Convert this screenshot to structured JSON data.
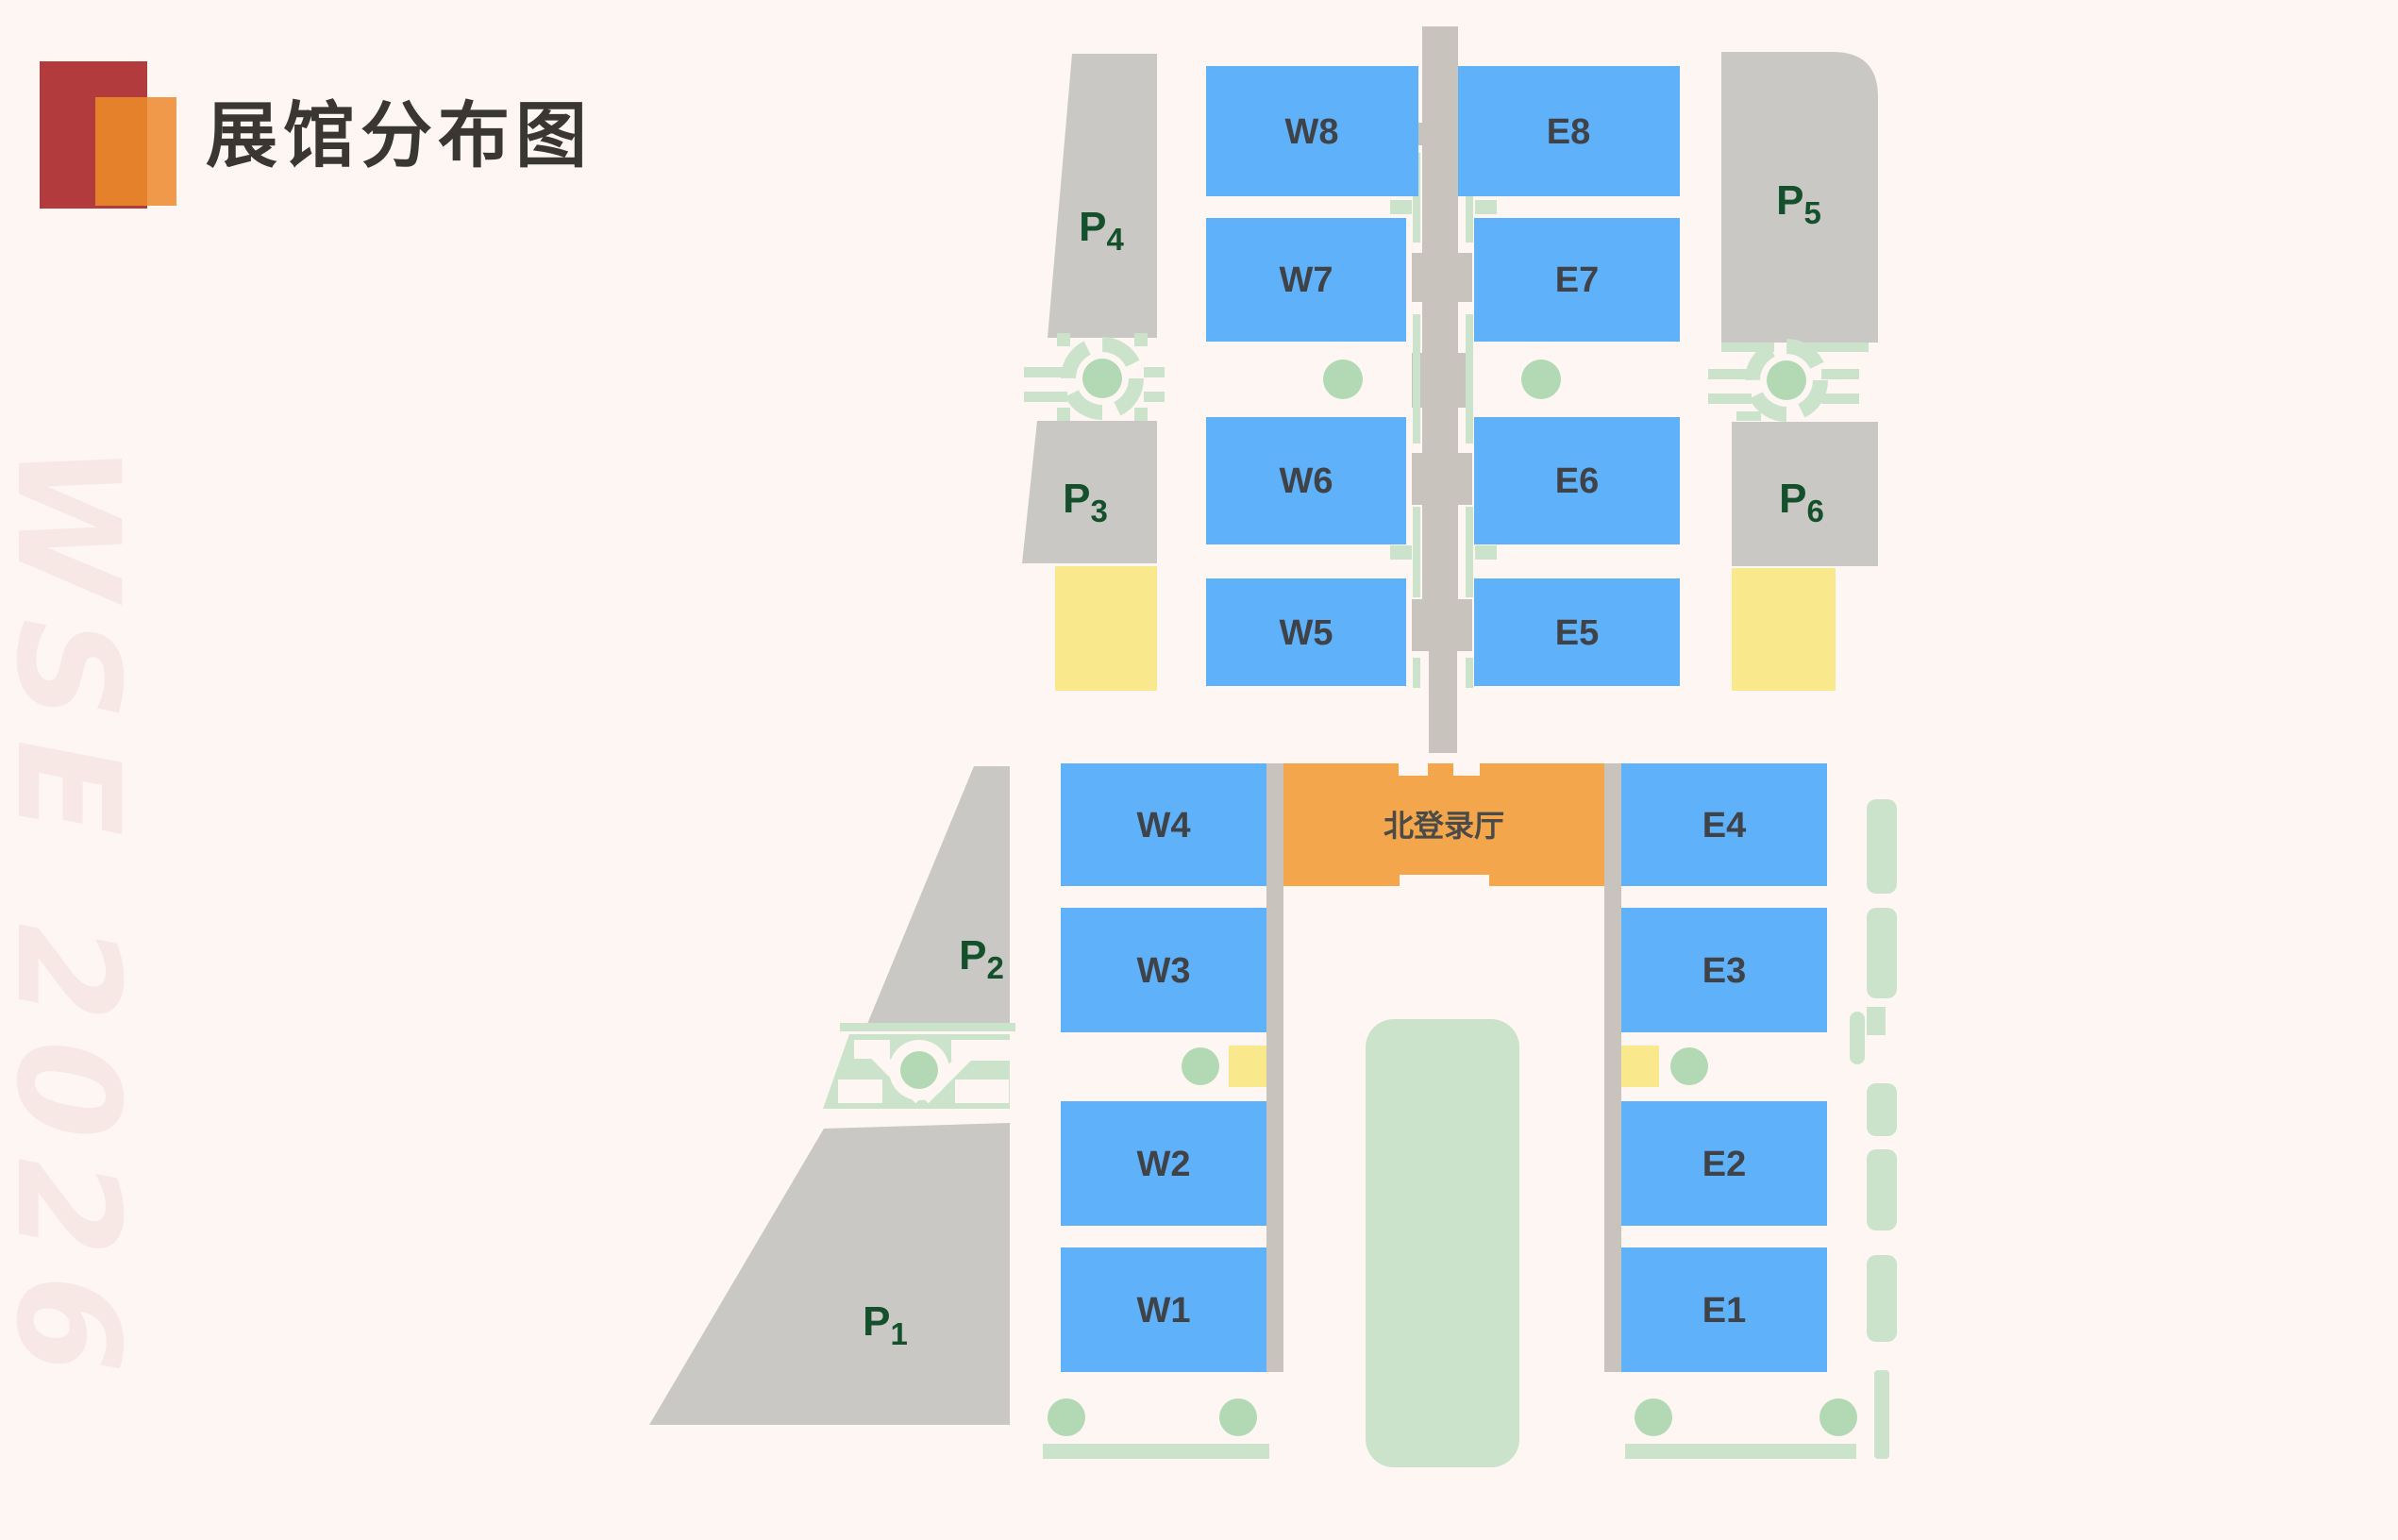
{
  "header": {
    "title": "展馆分布图"
  },
  "watermark": {
    "text": "WSE 2026"
  },
  "map": {
    "north_entrance_hall": {
      "label": "北登录厅"
    },
    "halls": {
      "W8": {
        "label": "W8"
      },
      "W7": {
        "label": "W7"
      },
      "W6": {
        "label": "W6"
      },
      "W5": {
        "label": "W5"
      },
      "W4": {
        "label": "W4"
      },
      "W3": {
        "label": "W3"
      },
      "W2": {
        "label": "W2"
      },
      "W1": {
        "label": "W1"
      },
      "E8": {
        "label": "E8"
      },
      "E7": {
        "label": "E7"
      },
      "E6": {
        "label": "E6"
      },
      "E5": {
        "label": "E5"
      },
      "E4": {
        "label": "E4"
      },
      "E3": {
        "label": "E3"
      },
      "E2": {
        "label": "E2"
      },
      "E1": {
        "label": "E1"
      }
    },
    "parking": {
      "P1": {
        "prefix": "P",
        "sub": "1"
      },
      "P2": {
        "prefix": "P",
        "sub": "2"
      },
      "P3": {
        "prefix": "P",
        "sub": "3"
      },
      "P4": {
        "prefix": "P",
        "sub": "4"
      },
      "P5": {
        "prefix": "P",
        "sub": "5"
      },
      "P6": {
        "prefix": "P",
        "sub": "6"
      }
    }
  },
  "colors": {
    "background": "#FDF6F2",
    "hall_blue": "#5FB1F9",
    "hall_text": "#3F4246",
    "parking_gray": "#C9C8C5",
    "corridor_gray": "#C8C4BD",
    "green_light": "#CBE3CB",
    "green_mid": "#B2D9B4",
    "yellow": "#FAE88D",
    "orange": "#F3A64B",
    "orange_text": "#4A4A48",
    "parking_label": "#15502C",
    "title_text": "#3A3632",
    "watermark_pink": "#F8E8E5",
    "logo_red": "#B23B3E",
    "logo_orange": "#E5802B",
    "logo_orange_light": "#F0994B"
  }
}
